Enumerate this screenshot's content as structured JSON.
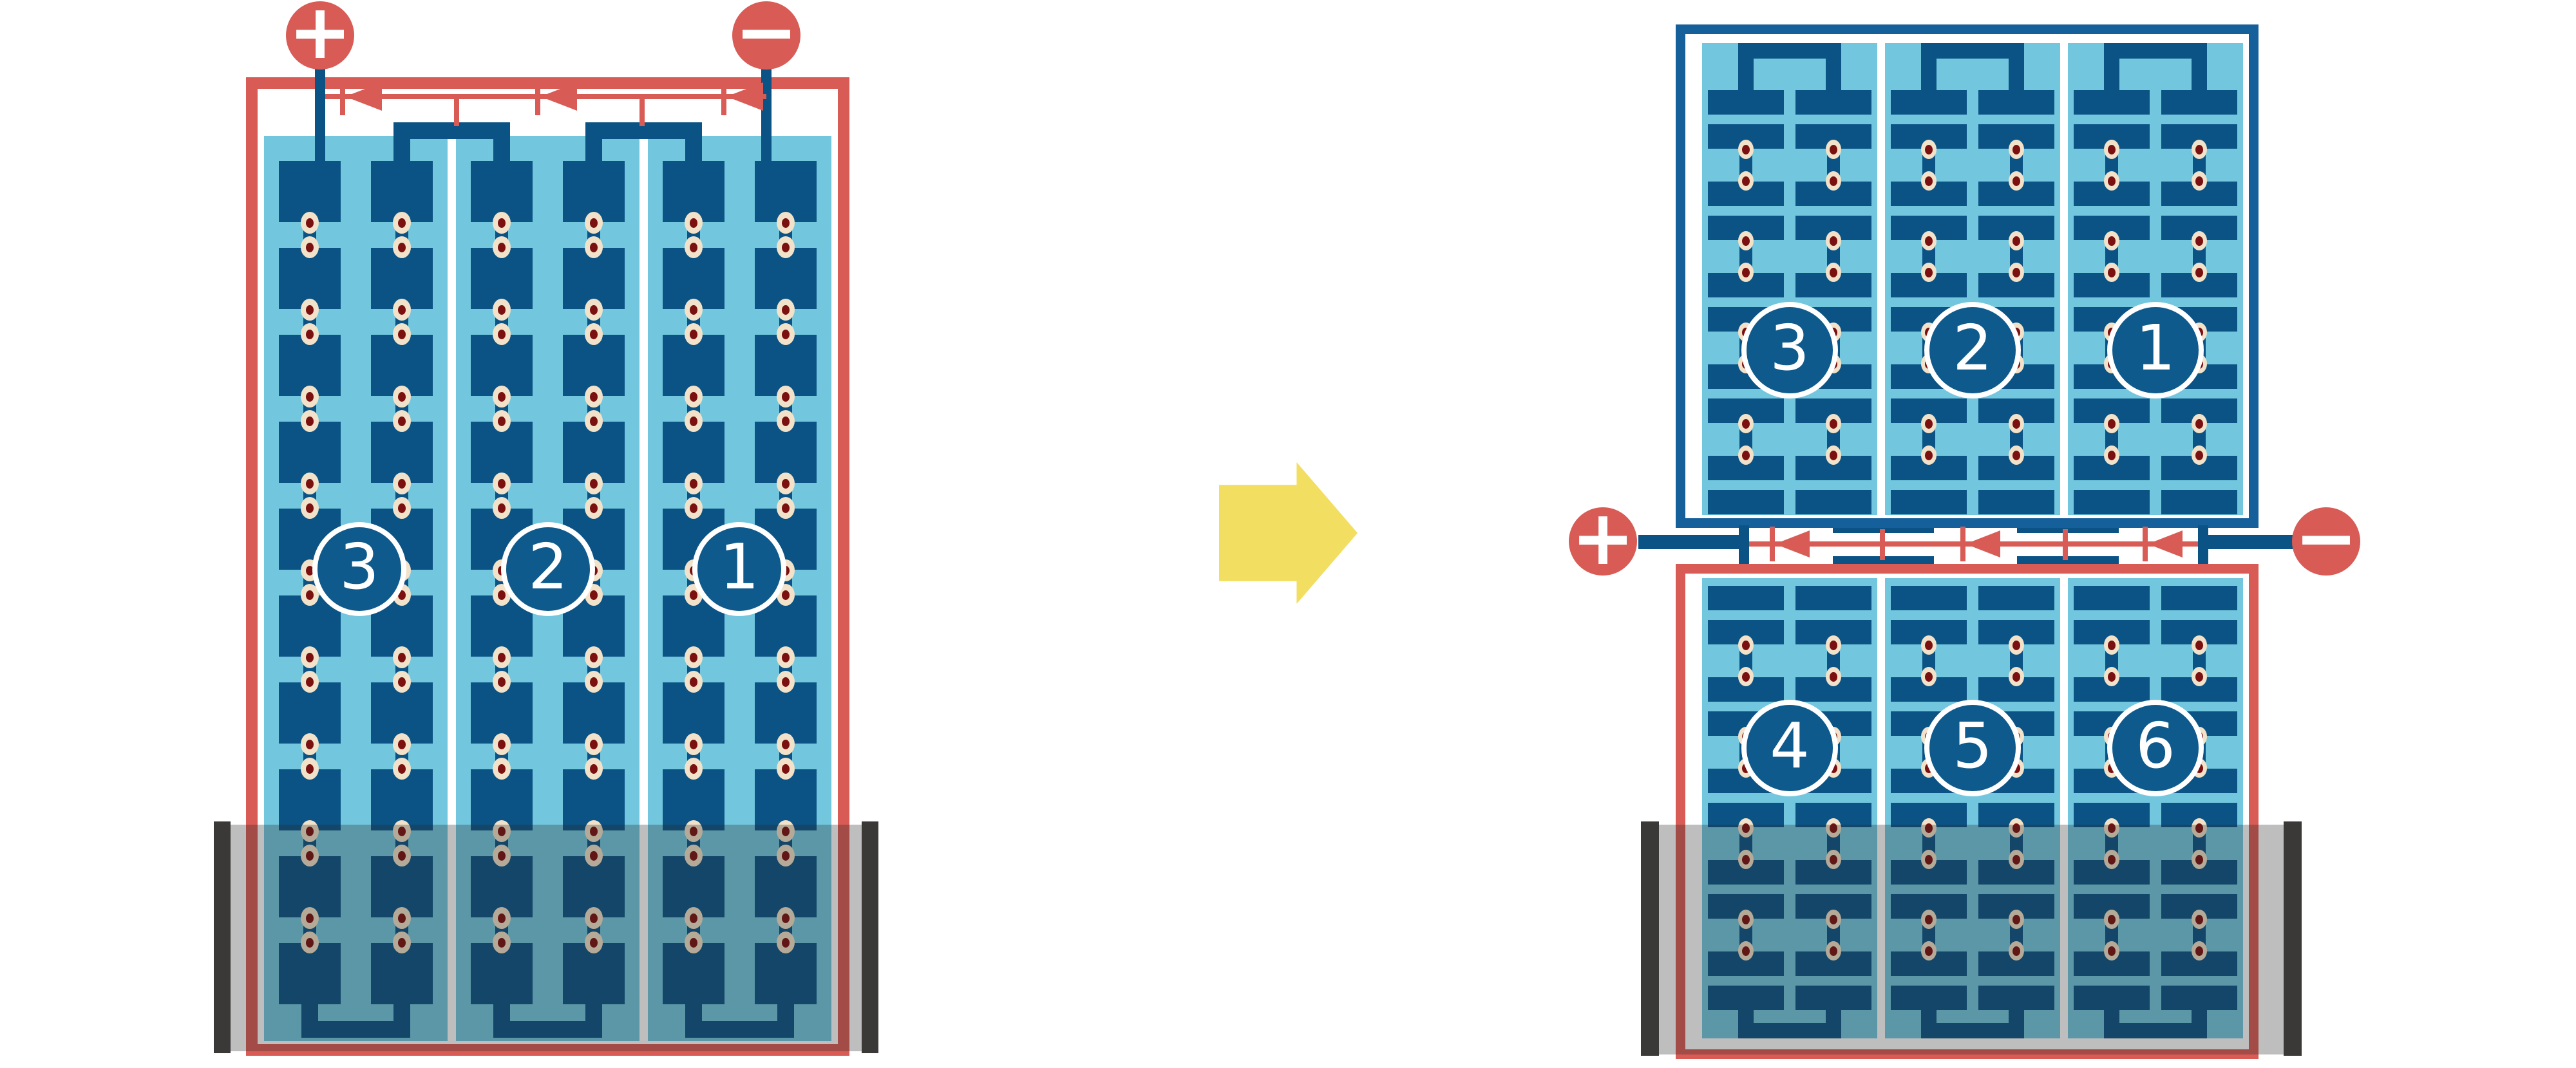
{
  "colors": {
    "light_blue": "#72C7DE",
    "cell_blue": "#0B5385",
    "frame_blue": "#15609B",
    "red": "#D85C55",
    "dot_ring": "#F2E2C9",
    "dot_center": "#7A100F",
    "yellow": "#F2DE60",
    "shade_cap": "#3B3838",
    "shade_body": "rgba(40,40,40,0.30)",
    "circle_fill": "#0F5A8C",
    "white": "#FFFFFF"
  },
  "left_module": {
    "positive_label": "+",
    "negative_label": "−",
    "string_labels": [
      "3",
      "2",
      "1"
    ],
    "cell_rows": 10,
    "cell_columns": 6,
    "bypass_diodes": 3
  },
  "transition_arrow": {
    "direction": "right"
  },
  "right_top_module": {
    "string_labels": [
      "3",
      "2",
      "1"
    ]
  },
  "right_bottom_module": {
    "string_labels": [
      "4",
      "5",
      "6"
    ]
  },
  "junction": {
    "positive_label": "+",
    "negative_label": "−",
    "bypass_diodes": 3
  }
}
